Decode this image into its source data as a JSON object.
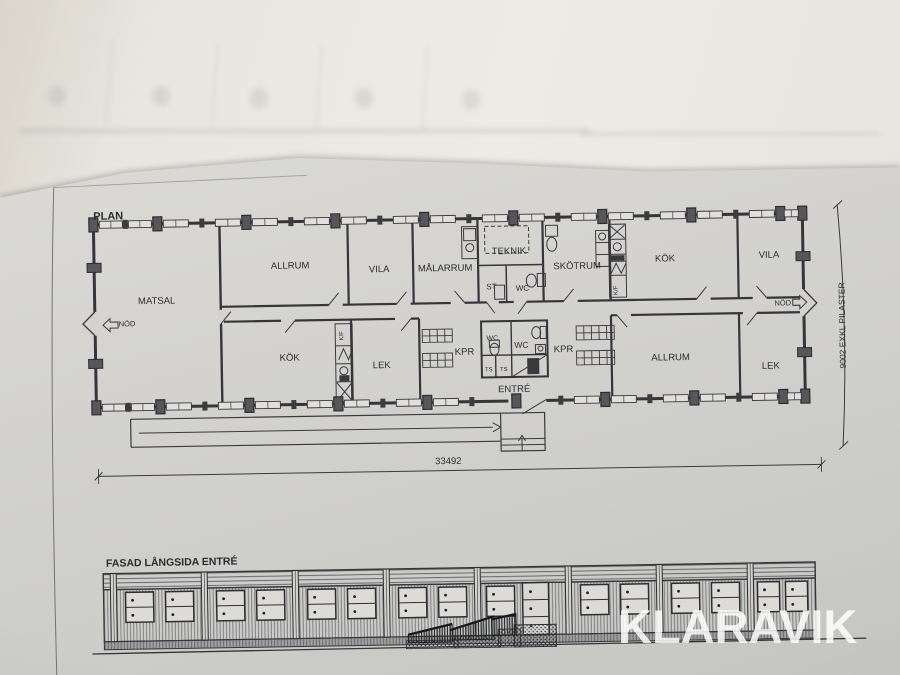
{
  "watermark": "KLARAVIK",
  "titles": {
    "plan": "PLAN",
    "facade": "FASAD LÅNGSIDA ENTRÉ"
  },
  "dimensions": {
    "width": "33492",
    "height": "9002 EXKL PILASTER"
  },
  "room_labels": [
    {
      "text": "MATSAL",
      "x": 158,
      "y": 299
    },
    {
      "text": "ALLRUM",
      "x": 292,
      "y": 266
    },
    {
      "text": "VILA",
      "x": 381,
      "y": 271
    },
    {
      "text": "MÅLARRUM",
      "x": 447,
      "y": 271
    },
    {
      "text": "TEKNIK",
      "x": 511,
      "y": 255
    },
    {
      "text": "ST",
      "x": 493,
      "y": 290,
      "s": 8
    },
    {
      "text": "WC",
      "x": 524,
      "y": 292,
      "s": 8
    },
    {
      "text": "SKÖTRUM",
      "x": 579,
      "y": 271
    },
    {
      "text": "KÖK",
      "x": 667,
      "y": 265
    },
    {
      "text": "VILA",
      "x": 771,
      "y": 263
    },
    {
      "text": "NÖD",
      "x": 128,
      "y": 321,
      "s": 7.5
    },
    {
      "text": "NÖD",
      "x": 784,
      "y": 311,
      "s": 7.5
    },
    {
      "text": "KÖK",
      "x": 290,
      "y": 358
    },
    {
      "text": "LEK",
      "x": 382,
      "y": 367
    },
    {
      "text": "KPR",
      "x": 465,
      "y": 355
    },
    {
      "text": "WC",
      "x": 493,
      "y": 341,
      "s": 7
    },
    {
      "text": "WC",
      "x": 522,
      "y": 349,
      "s": 8.5
    },
    {
      "text": "TS",
      "x": 489,
      "y": 372,
      "s": 6
    },
    {
      "text": "TS",
      "x": 504,
      "y": 372,
      "s": 6
    },
    {
      "text": "KPR",
      "x": 564,
      "y": 354
    },
    {
      "text": "ALLRUM",
      "x": 671,
      "y": 364
    },
    {
      "text": "LEK",
      "x": 771,
      "y": 374
    },
    {
      "text": "ENTRÉ",
      "x": 514,
      "y": 393
    },
    {
      "text": "K/F",
      "x": 344,
      "y": 334,
      "s": 6,
      "r": -90
    },
    {
      "text": "K/F",
      "x": 619,
      "y": 293,
      "s": 6,
      "r": -90
    }
  ]
}
